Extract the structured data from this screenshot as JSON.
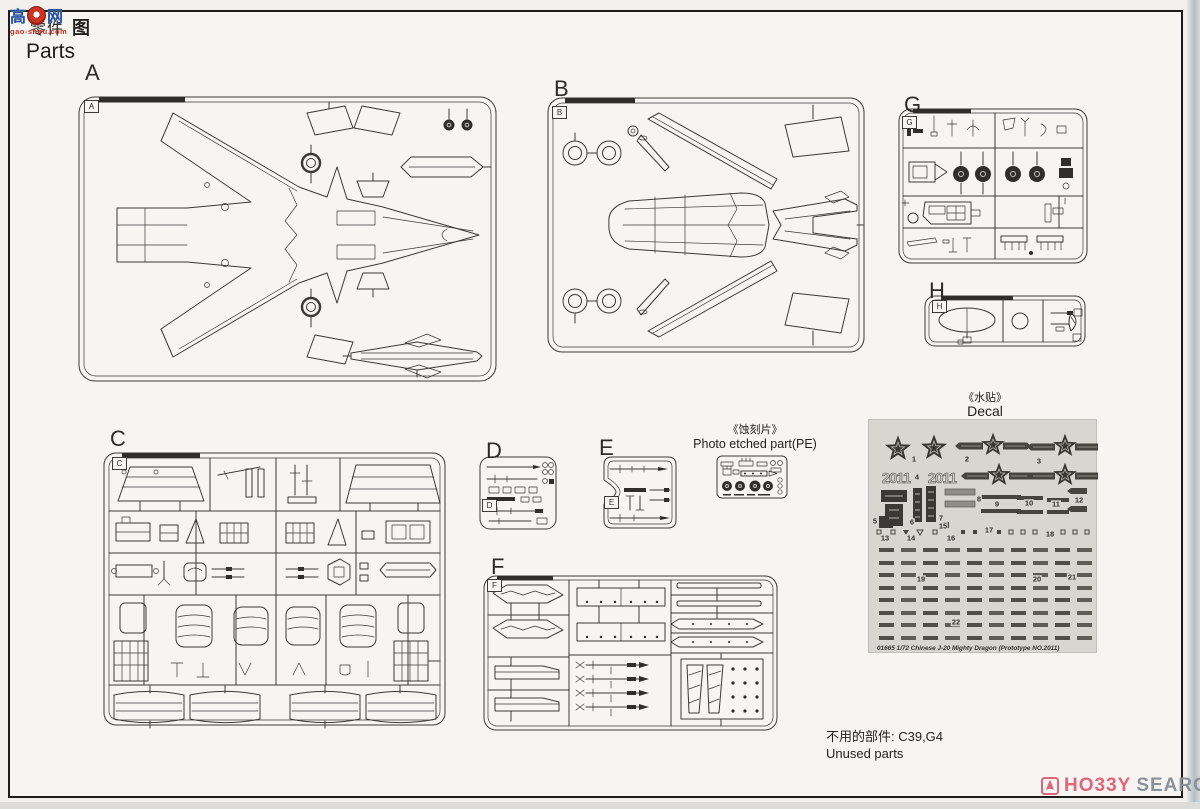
{
  "page": {
    "title": "Parts",
    "watermark": {
      "char_left": "高",
      "char_right": "网",
      "char_tu": "图",
      "hidden_text": "零件",
      "site": "gao-shou.com"
    },
    "brand": {
      "part1": "HO33Y",
      "part2": "SEARCH"
    }
  },
  "sections": {
    "pe": {
      "zh": "《蚀刻片》",
      "en": "Photo etched part(PE)"
    },
    "decal": {
      "zh": "《水贴》",
      "en": "Decal",
      "serials": [
        "2011",
        "2011"
      ],
      "footer": "01665 1/72  Chinese J-20 Mighty Dragon (Prototype NO.2011)"
    },
    "unused": {
      "zh": "不用的部件: C39,G4",
      "en": "Unused parts"
    }
  },
  "colors": {
    "brand_pink": "#e0647a",
    "brand_gray": "#8b9198",
    "watermark_blue": "#2d4fa3",
    "watermark_red": "#cc2f22",
    "decal_sheet_bg": "#d7d6d1",
    "line_art": "#3b3a37"
  },
  "sprues": [
    {
      "letter": "A",
      "lx": 85,
      "ly": 60,
      "bx": 84,
      "by": 100
    },
    {
      "letter": "B",
      "lx": 554,
      "ly": 76,
      "bx": 552,
      "by": 106
    },
    {
      "letter": "C",
      "lx": 110,
      "ly": 426,
      "bx": 112,
      "by": 457
    },
    {
      "letter": "D",
      "lx": 486,
      "ly": 438,
      "bx": 482,
      "by": 499
    },
    {
      "letter": "E",
      "lx": 599,
      "ly": 435,
      "bx": 604,
      "by": 496
    },
    {
      "letter": "F",
      "lx": 491,
      "ly": 554,
      "bx": 487,
      "by": 579
    },
    {
      "letter": "G",
      "lx": 904,
      "ly": 92,
      "bx": 902,
      "by": 116
    },
    {
      "letter": "H",
      "lx": 929,
      "ly": 278,
      "bx": 932,
      "by": 300
    }
  ],
  "decal_markers": [
    {
      "label": "1",
      "x": 45,
      "y": 39
    },
    {
      "label": "2",
      "x": 98,
      "y": 39
    },
    {
      "label": "3",
      "x": 170,
      "y": 41
    },
    {
      "label": "4",
      "x": 48,
      "y": 57
    },
    {
      "label": "5",
      "x": 6,
      "y": 101
    },
    {
      "label": "6",
      "x": 43,
      "y": 102
    },
    {
      "label": "7",
      "x": 72,
      "y": 98
    },
    {
      "label": "8",
      "x": 110,
      "y": 79
    },
    {
      "label": "9",
      "x": 128,
      "y": 84
    },
    {
      "label": "10",
      "x": 160,
      "y": 83
    },
    {
      "label": "11",
      "x": 187,
      "y": 84
    },
    {
      "label": "12",
      "x": 210,
      "y": 80
    },
    {
      "label": "13",
      "x": 16,
      "y": 118
    },
    {
      "label": "14",
      "x": 42,
      "y": 118
    },
    {
      "label": "15",
      "x": 74,
      "y": 106
    },
    {
      "label": "16",
      "x": 82,
      "y": 118
    },
    {
      "label": "17",
      "x": 120,
      "y": 110
    },
    {
      "label": "18",
      "x": 181,
      "y": 114
    },
    {
      "label": "19",
      "x": 52,
      "y": 159
    },
    {
      "label": "20",
      "x": 168,
      "y": 159
    },
    {
      "label": "21",
      "x": 203,
      "y": 157
    },
    {
      "label": "22",
      "x": 87,
      "y": 202
    }
  ],
  "dash_grid": {
    "rows": 8,
    "cols": 10,
    "x0": 10,
    "y0": 128,
    "dx": 22,
    "dy": 12.5,
    "w": 15,
    "h": 4,
    "color_a": "#4f4e48",
    "color_b": "#5e5c55"
  }
}
